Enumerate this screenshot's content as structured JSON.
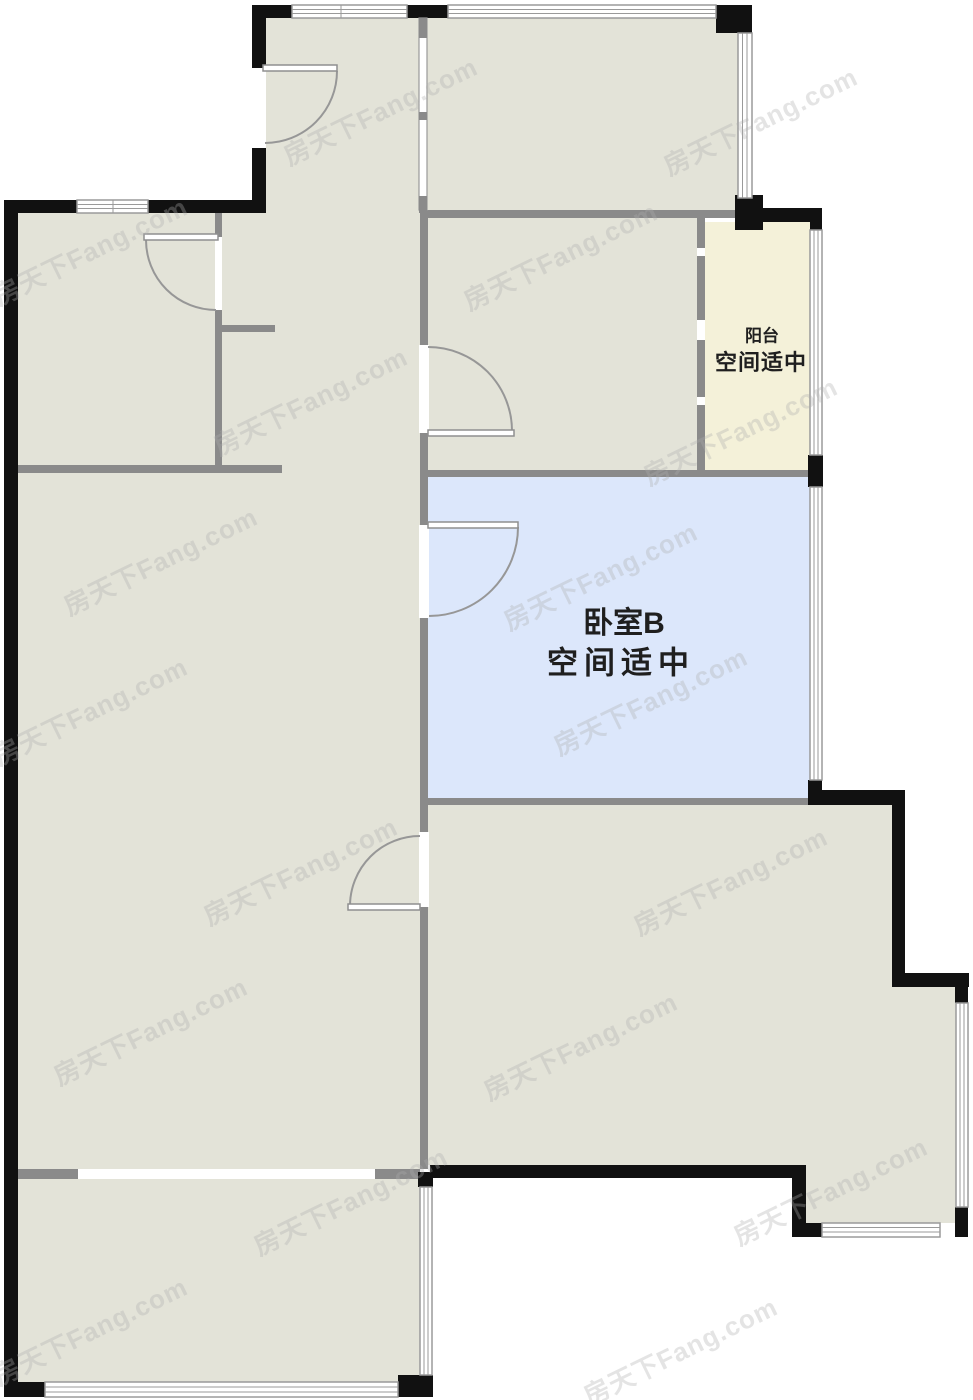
{
  "palette": {
    "room_fill": "#e3e3d8",
    "highlight_room_fill": "#dce7fb",
    "balcony_fill": "#f4f1d9",
    "interior_wall": "#8a8a8a",
    "exterior_wall": "#111111",
    "window_line": "#9a9a9a",
    "label_color": "#1f1f1f",
    "watermark_color": "#aeaeae"
  },
  "rooms": {
    "balcony": {
      "name": "阳台",
      "assessment": "空间适中"
    },
    "bedroom_b": {
      "name": "卧室B",
      "assessment": "空间适中"
    }
  },
  "watermark": {
    "text": "房天下Fang.com"
  }
}
